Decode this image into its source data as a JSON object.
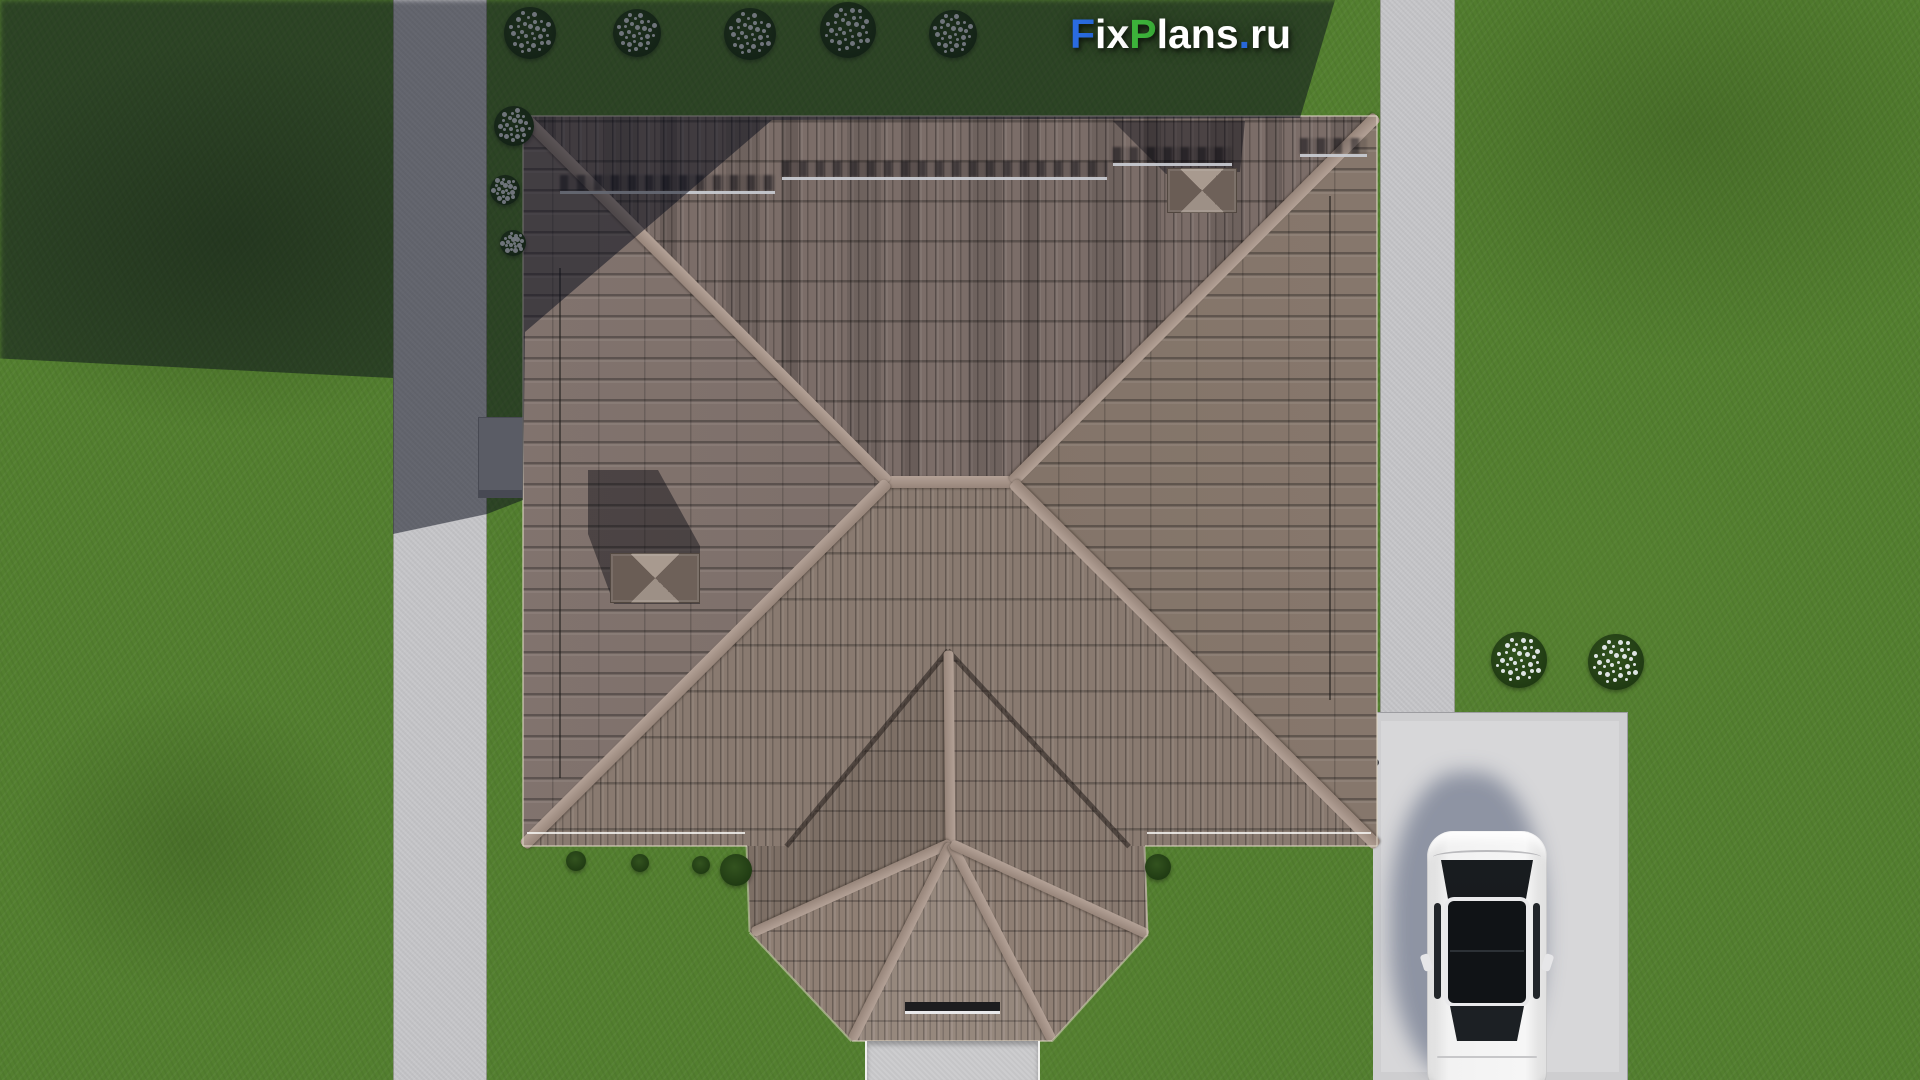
{
  "watermark": {
    "text": "FixPlans.ru",
    "parts": [
      {
        "text": "F",
        "color": "#2a6bdf"
      },
      {
        "text": "ix",
        "color": "#ffffff"
      },
      {
        "text": "P",
        "color": "#3cb23a"
      },
      {
        "text": "lans",
        "color": "#ffffff"
      },
      {
        "text": ".",
        "color": "#2a6bdf"
      },
      {
        "text": "ru",
        "color": "#ffffff"
      }
    ]
  },
  "palette": {
    "grass": "#537f2f",
    "grass_shadow": "rgba(10,14,26,0.52)",
    "sidewalk_concrete": "#c6c6c9",
    "driveway_concrete": "#d7d7d9",
    "roof_tile_base": "#837468",
    "roof_ridge": "#a3917f",
    "roof_valley": "rgba(25,20,18,0.5)",
    "chimney_cap_light": "#a89a8f",
    "chimney_cap_dark": "#6e6159",
    "car_body": "#efefef",
    "car_glass": "#15181c",
    "flower_white": "#eef2f5",
    "bush_green": "#2c4a1c"
  }
}
